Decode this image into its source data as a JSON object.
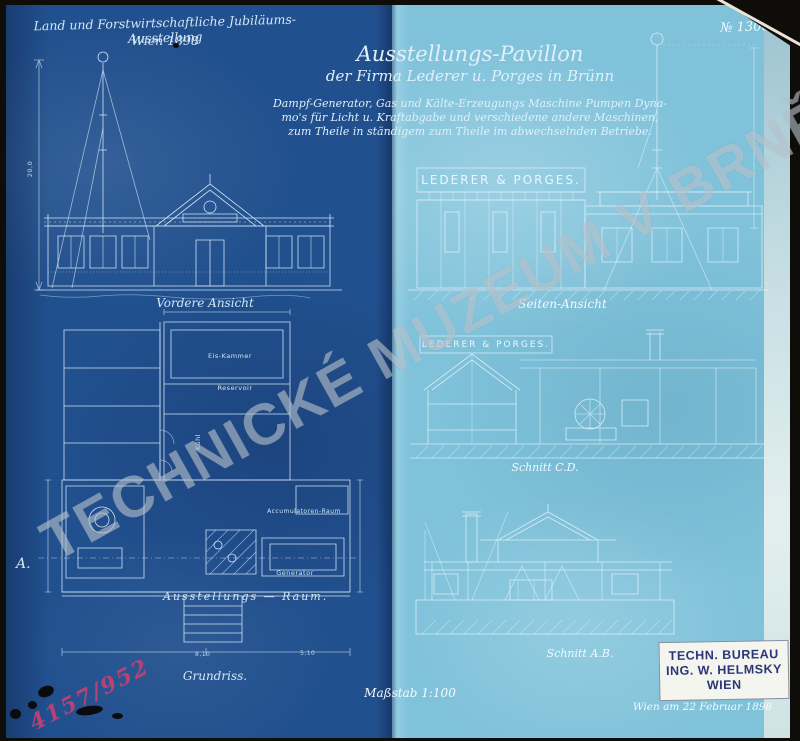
{
  "watermark": "TECHNICKÉ MUZEUM V BRNĚ",
  "number": "№ 1306",
  "red_note": "4157/952",
  "header": {
    "line1": "Land und Forstwirtschaftliche Jubiläums-Ausstellung",
    "line2": "Wien 1898"
  },
  "title": {
    "line1": "Ausstellungs-Pavillon",
    "line2": "der Firma Lederer u. Porges in Brünn"
  },
  "desc": {
    "line1": "Dampf-Generator, Gas und Kälte-Erzeugungs Maschine Pumpen Dyna-",
    "line2": "mo's für Licht u. Kraftabgabe und verschiedene andere Maschinen,",
    "line3": "zum Theile in ständigem zum Theile im abwechselnden Betriebe."
  },
  "sign": "LEDERER & PORGES.",
  "labels": {
    "front": "Vordere Ansicht",
    "side": "Seiten-Ansicht",
    "section_cd": "Schnitt C.D.",
    "section_ab": "Schnitt A.B.",
    "hall": "Ausstellungs — Raum.",
    "plan": "Grundriss.",
    "scale": "Maßstab 1:100",
    "marker": "A."
  },
  "rooms": {
    "ice": "Eis-Kammer",
    "reservoir": "Reservoir",
    "cool": "Kühl",
    "accumulator": "Accumulatoren-Raum",
    "generator": "Generator"
  },
  "dims": {
    "mast": "20,0",
    "plan_left": "8,10",
    "plan_right": "5,10"
  },
  "stamp": {
    "line1": "TECHN. BUREAU",
    "line2": "ING. W. HELMSKY",
    "line3": "WIEN"
  },
  "date": "Wien am 22 Februar 1898",
  "colors": {
    "dark_panel": "#21508e",
    "light_panel": "#7fc2da",
    "line_ink": "#e2f2fc",
    "stamp_ink": "#2b3678",
    "red_note": "#cc4070"
  }
}
